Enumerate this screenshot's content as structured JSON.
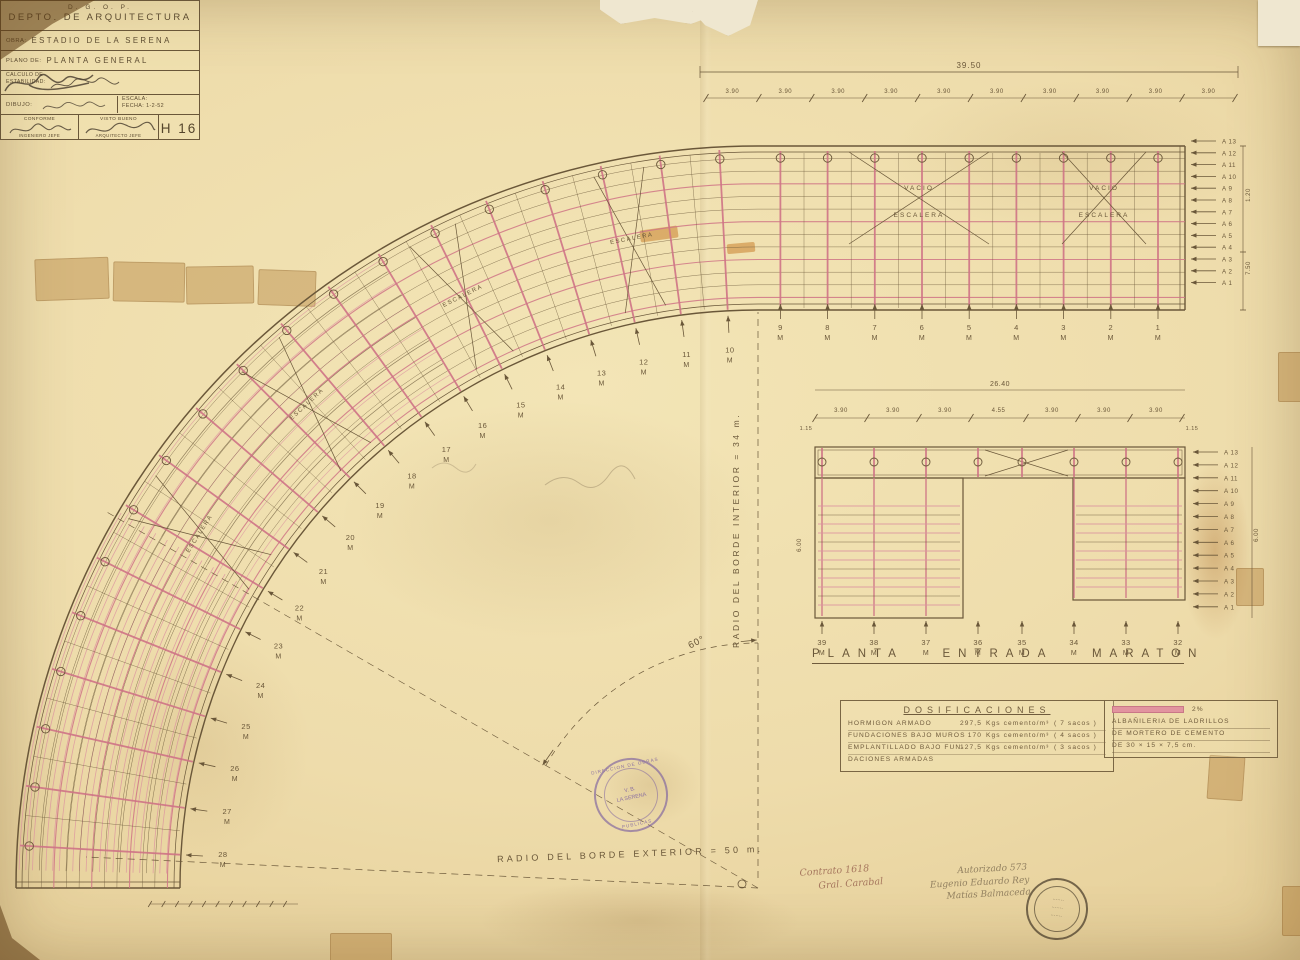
{
  "colors": {
    "paper": "#eedcab",
    "ink": "#6a5739",
    "pink": "#cf7486",
    "pink_light": "#dc93a0",
    "purple_stamp": "#7b5fa0",
    "black_stamp": "#574a38"
  },
  "upper_plan": {
    "overall_dim": "39.50",
    "segment_dim": "3.90",
    "column_labels": [
      "1",
      "2",
      "3",
      "4",
      "5",
      "6",
      "7",
      "8",
      "9"
    ],
    "unit": "M",
    "row_labels": [
      "A 13",
      "A 12",
      "A 11",
      "A 10",
      "A 9",
      "A 8",
      "A 7",
      "A 6",
      "A 5",
      "A 4",
      "A 3",
      "A 2",
      "A 1"
    ],
    "side_dims": [
      "1.20",
      "7.50"
    ],
    "void_label": "VACIO",
    "stair_label": "ESCALERA"
  },
  "curve": {
    "labels": [
      "10",
      "11",
      "12",
      "13",
      "14",
      "15",
      "16",
      "17",
      "18",
      "19",
      "20",
      "21",
      "22",
      "23",
      "24",
      "25",
      "26",
      "27",
      "28"
    ],
    "unit": "M"
  },
  "construction": {
    "inner_radius_label": "RADIO DEL BORDE INTERIOR = 34 m.",
    "outer_radius_label": "RADIO DEL BORDE EXTERIOR = 50 m.",
    "angle_label": "60°"
  },
  "lower_plan": {
    "title": "PLANTA ENTRADA MARATON",
    "overall_dim": "26.40",
    "segment_dims": [
      "3.90",
      "3.90",
      "3.90",
      "4.55",
      "3.90",
      "3.90",
      "3.90"
    ],
    "edge_dim": "1.15",
    "side_dim": "6.00",
    "column_labels": [
      "39",
      "38",
      "37",
      "36",
      "35",
      "34",
      "33",
      "32"
    ],
    "unit": "M",
    "row_labels": [
      "A 13",
      "A 12",
      "A 11",
      "A 10",
      "A 9",
      "A 8",
      "A 7",
      "A 6",
      "A 5",
      "A 4",
      "A 3",
      "A 2",
      "A 1"
    ]
  },
  "dosificaciones": {
    "title": "DOSIFICACIONES",
    "rows": [
      {
        "name": "HORMIGON ARMADO",
        "value": "297,5",
        "unit": "Kgs cemento/m³",
        "sacks": "( 7 sacos )"
      },
      {
        "name": "FUNDACIONES BAJO MUROS",
        "value": "170",
        "unit": "Kgs cemento/m³",
        "sacks": "( 4 sacos )"
      },
      {
        "name": "EMPLANTILLADO BAJO FUN-",
        "value": "127,5",
        "unit": "Kgs cemento/m³",
        "sacks": "( 3 sacos )"
      },
      {
        "name": "DACIONES ARMADAS",
        "value": "",
        "unit": "",
        "sacks": ""
      }
    ],
    "legend_label": "2%",
    "note_lines": [
      "ALBAÑILERIA DE LADRILLOS",
      "DE MORTERO DE CEMENTO",
      "DE 30 × 15 × 7,5 cm."
    ]
  },
  "title_block": {
    "org": "D. G. O. P.",
    "department": "DEPTO. DE ARQUITECTURA",
    "obra_label": "OBRA:",
    "obra": "ESTADIO DE LA SERENA",
    "plano_label": "PLANO DE:",
    "plano": "PLANTA GENERAL",
    "calculo_label1": "CALCULO DE",
    "calculo_label2": "ESTABILIDAD:",
    "dibujo_label": "DIBUJO:",
    "escala_label": "ESCALA:",
    "fecha_label": "FECHA:",
    "fecha": "1-2-52",
    "conforme_label": "CONFORME",
    "ingeniero_label": "INGENIERO JEFE",
    "visto_label": "VISTO BUENO",
    "arquitecto_label": "ARQUITECTO JEFE",
    "sheet_number": "H 16"
  },
  "stamps": {
    "purple": {
      "ring_top": "DIRECCION DE OBRAS",
      "ring_bottom": "PUBLICAS",
      "center_line1": "V. B.",
      "center_line2": "LA SERENA"
    },
    "black": {
      "line1": "·······",
      "line2": "·······",
      "line3": "·······"
    }
  },
  "handwriting": {
    "note1_line1": "Contrato 1618",
    "note1_line2": "Gral. Carabal",
    "note2_line1": "Autorizado 573",
    "note2_line2": "Eugenio Eduardo Rey",
    "note2_line3": "Matías Balmaceda"
  }
}
